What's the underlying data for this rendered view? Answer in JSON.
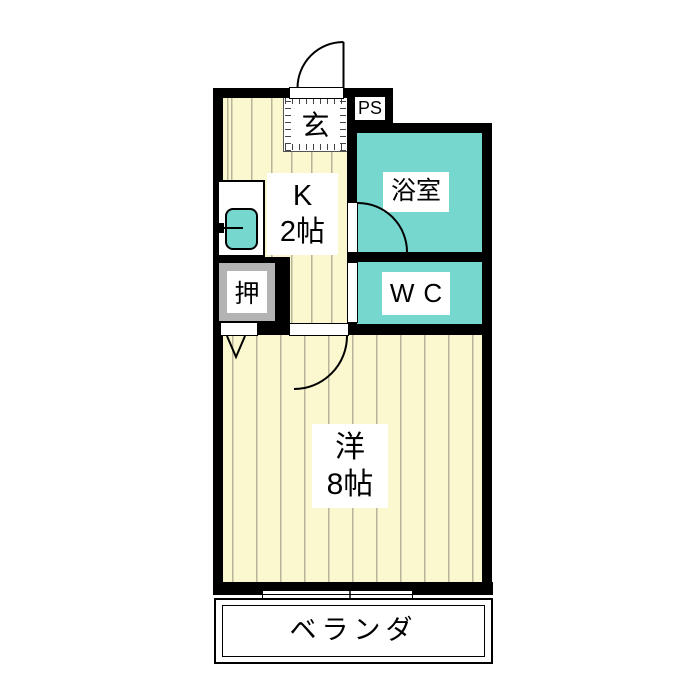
{
  "plan": {
    "type": "japanese-apartment-floorplan",
    "labels": {
      "entrance": "玄",
      "pipe_space": "PS",
      "kitchen_line1": "K",
      "kitchen_line2": "2帖",
      "bathroom": "浴室",
      "wc": "WC",
      "closet": "押",
      "main_room_line1": "洋",
      "main_room_line2": "8帖",
      "balcony": "ベランダ"
    },
    "colors": {
      "wall": "#000000",
      "wet_room_fill": "#76d7cf",
      "floor_fill": "#fbf7cf",
      "floor_stripe": "#b7b49c",
      "closet_frame": "#b3b3b3",
      "sink_fill": "#76d7cf",
      "background": "#ffffff"
    }
  }
}
